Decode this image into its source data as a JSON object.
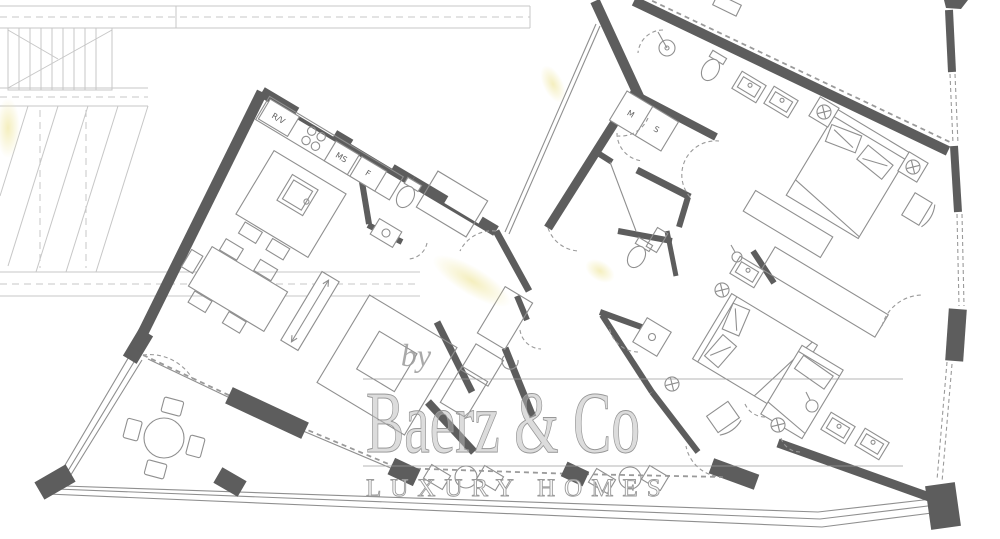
{
  "labels": {
    "rv": "R/V",
    "ms": "MS",
    "f": "F",
    "m": "M",
    "s": "S"
  },
  "watermark": {
    "prefix": "by",
    "brand": "Baerz & Co",
    "tagline": "LUXURY HOMES"
  },
  "colors": {
    "wall": "#5d5d5d",
    "mid": "#787878",
    "line": "#8f8f8f",
    "faint": "#c7c7c7",
    "dash": "#9a9a9a",
    "label": "#5f5f5f",
    "watermark": "#9b9b9b",
    "highlight": "#f1e9a8",
    "background": "#ffffff"
  }
}
